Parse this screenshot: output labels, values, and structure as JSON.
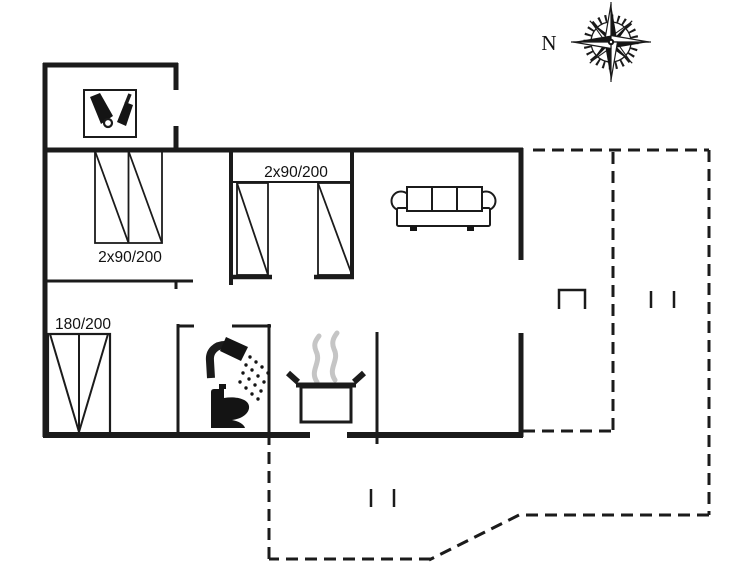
{
  "page": {
    "type": "holiday-house-floor-plan",
    "background": "#ffffff"
  },
  "colors": {
    "line": "#1b1b1b",
    "steam": "#c5c5c5",
    "text": "#111111"
  },
  "compass": {
    "label": "N"
  },
  "labels": {
    "bed_top_left": "2x90/200",
    "bed_middle": "2x90/200",
    "bed_bottom_left": "180/200"
  },
  "icons": [
    "compass-rose-icon",
    "utility-icon",
    "single-bed-icon",
    "double-bed-icon",
    "sofa-icon",
    "shower-icon",
    "toilet-icon",
    "cooking-pot-icon",
    "steam-icon",
    "terrace-marker-icon"
  ]
}
